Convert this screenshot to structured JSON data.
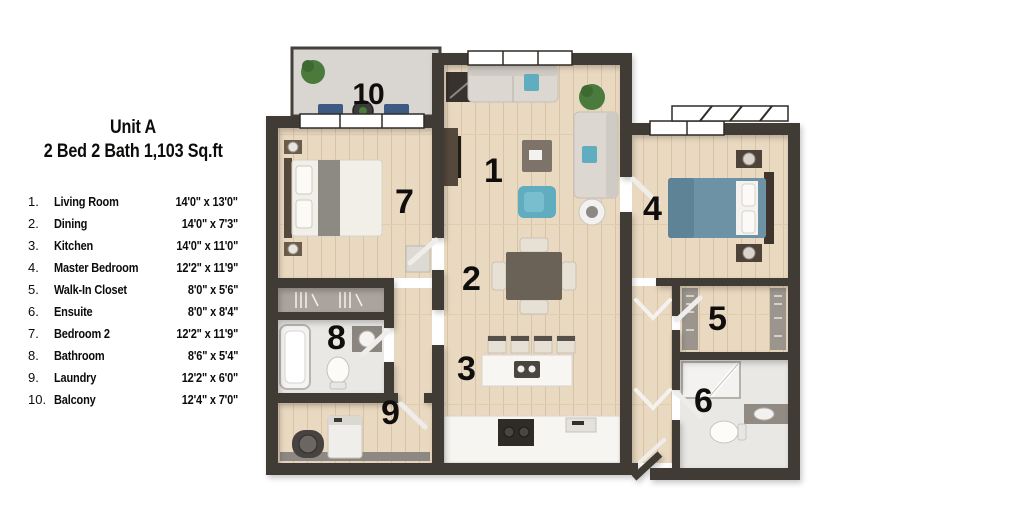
{
  "title": {
    "line1": "Unit A",
    "line2": "2 Bed 2 Bath 1,103 Sq.ft"
  },
  "legend": {
    "items": [
      {
        "num": "1.",
        "name": "Living Room",
        "dim": "14'0\" x 13'0\""
      },
      {
        "num": "2.",
        "name": "Dining",
        "dim": "14'0\" x 7'3\""
      },
      {
        "num": "3.",
        "name": "Kitchen",
        "dim": "14'0\" x 11'0\""
      },
      {
        "num": "4.",
        "name": "Master Bedroom",
        "dim": "12'2\" x 11'9\""
      },
      {
        "num": "5.",
        "name": "Walk-In Closet",
        "dim": "8'0\" x 5'6\""
      },
      {
        "num": "6.",
        "name": "Ensuite",
        "dim": "8'0\" x 8'4\""
      },
      {
        "num": "7.",
        "name": "Bedroom 2",
        "dim": "12'2\" x 11'9\""
      },
      {
        "num": "8.",
        "name": "Bathroom",
        "dim": "8'6\" x 5'4\""
      },
      {
        "num": "9.",
        "name": "Laundry",
        "dim": "12'2\" x 6'0\""
      },
      {
        "num": "10.",
        "name": "Balcony",
        "dim": "12'4\" x 7'0\""
      }
    ]
  },
  "plan": {
    "room_labels": [
      {
        "n": "1",
        "room": "living-room"
      },
      {
        "n": "2",
        "room": "dining"
      },
      {
        "n": "3",
        "room": "kitchen"
      },
      {
        "n": "4",
        "room": "master-bedroom"
      },
      {
        "n": "5",
        "room": "walk-in-closet"
      },
      {
        "n": "6",
        "room": "ensuite"
      },
      {
        "n": "7",
        "room": "bedroom-2"
      },
      {
        "n": "8",
        "room": "bathroom"
      },
      {
        "n": "9",
        "room": "laundry"
      },
      {
        "n": "10",
        "room": "balcony"
      }
    ],
    "colors": {
      "wall": "#413b35",
      "wood_floor": "#ead9c1",
      "wood_plank_line": "#d9c3a6",
      "balcony_floor": "#d9d6d2",
      "tile_floor": "#eae8e5",
      "sofa_gray": "#dcd8d1",
      "accent_teal": "#5fadbe",
      "balcony_chair_navy": "#3c5a82",
      "master_bed_blue": "#6d91a5",
      "plant_green": "#4a7a3c",
      "counter_white": "#f7f6f3",
      "dark_wood": "#55493c",
      "label_black": "#0f0e0c"
    }
  }
}
